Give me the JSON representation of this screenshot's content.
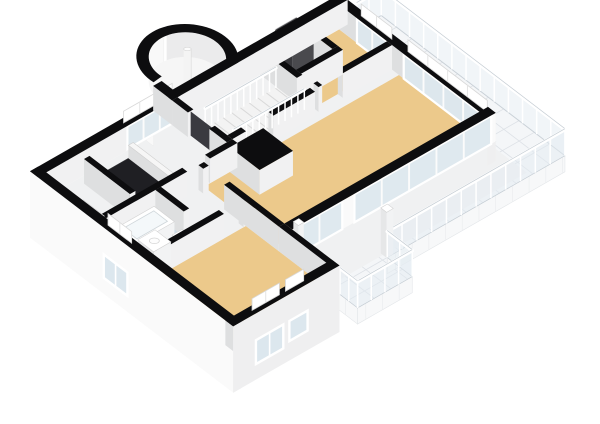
{
  "scene": {
    "label": "3d-floor-plan-isometric-view",
    "width": 600,
    "height": 424,
    "background": "#FFFFFF"
  },
  "palette": {
    "wallTop": "#0D0D0F",
    "wallFaceLight": "#F1F1F2",
    "wallFaceDark": "#DEDFE0",
    "facade": "#FAFAFA",
    "facadeSE": "#EFEFF0",
    "floorWood": "#ECC98B",
    "floorBath": "#CCDAE4",
    "floorBase": "#F0F1F2",
    "floorStone": "#EBEBEC",
    "stairFloor": "#F3F3F3",
    "tile": "#F4F6F8",
    "tileLine": "#DDE1E6",
    "glass": "#DCE7EE",
    "glassRail": "#E4ECF2",
    "frame": "#FFFFFF",
    "frameLine": "#D8D8D8",
    "dark": "#1F1F23",
    "darkDoor": "#3A3A40",
    "boiler": "#4A4A4E",
    "boilerSide": "#38383C",
    "red": "#C23B2E",
    "railPost": "#FFFFFF",
    "railStroke": "#C4CCD3",
    "treadLine": "#D9D9D9"
  },
  "floors": [
    {
      "name": "floor-hall-base",
      "rect": [
        0.28,
        0.28,
        9.92,
        7.02
      ],
      "color": "floorBase"
    },
    {
      "name": "floor-living-room",
      "rect": [
        3.5,
        2.43,
        9.92,
        5.32
      ],
      "color": "floorWood"
    },
    {
      "name": "floor-bedroom-northeast",
      "rect": [
        7.5,
        0.28,
        9.92,
        2.0
      ],
      "color": "floorWood"
    },
    {
      "name": "floor-utility-closet",
      "rect": [
        7.5,
        0.28,
        8.88,
        1.55
      ],
      "color": "floorStone"
    },
    {
      "name": "floor-bedroom-southwest",
      "rect": [
        0.28,
        4.13,
        3.32,
        7.02
      ],
      "color": "floorWood"
    },
    {
      "name": "floor-bathroom",
      "rect": [
        0.28,
        2.43,
        1.9,
        3.95
      ],
      "color": "floorBath"
    },
    {
      "name": "floor-staircase",
      "rect": [
        4.85,
        0.85,
        7.32,
        1.95
      ],
      "color": "stairFloor",
      "kind": "stairs",
      "treadStep": 0.285
    }
  ],
  "stairVoid": {
    "name": "stairwell-void",
    "rect": [
      1.5,
      0.5,
      2.78,
      2.15
    ],
    "color": "dark"
  },
  "terrace": {
    "name": "terrace",
    "z": -0.15,
    "poly": [
      [
        10.2,
        0.45
      ],
      [
        11.15,
        0.45
      ],
      [
        11.15,
        7.05
      ],
      [
        5.3,
        7.05
      ],
      [
        5.3,
        7.95
      ],
      [
        3.5,
        7.95
      ],
      [
        3.5,
        5.6
      ],
      [
        10.2,
        5.6
      ]
    ],
    "gridStep": 0.55,
    "fascia": [
      {
        "plane": "y",
        "at": 7.95,
        "range": [
          3.5,
          5.3
        ]
      },
      {
        "plane": "x",
        "at": 3.5,
        "range": [
          5.6,
          7.95
        ]
      },
      {
        "plane": "y",
        "at": 7.05,
        "range": [
          5.3,
          11.15
        ]
      }
    ],
    "edges": [
      {
        "from": [
          11.15,
          0.45
        ],
        "to": [
          11.15,
          7.05
        ]
      },
      {
        "from": [
          10.34,
          0.45
        ],
        "to": [
          11.15,
          0.45
        ]
      }
    ]
  },
  "elements3d": [
    {
      "type": "wall",
      "name": "wall-north-exterior",
      "rect": [
        0,
        0,
        10.2,
        0.28
      ],
      "swColor": "facade",
      "swBase": -1.6,
      "glassSE": [
        {
          "range": [
            2.95,
            4.55
          ],
          "n": 3,
          "zb": 0.06,
          "zt": 0.93
        }
      ],
      "caps": [
        {
          "side": "se",
          "range": [
            2.95,
            4.55
          ],
          "n": 3
        }
      ]
    },
    {
      "type": "wall",
      "name": "wall-northeast-glazed",
      "rect": [
        9.92,
        0,
        10.2,
        5.6
      ],
      "seColor": "facadeSE",
      "seBase": -0.9,
      "glassSW": [
        {
          "range": [
            0.92,
            2.02
          ],
          "n": 2,
          "zb": 0,
          "zt": 0.93
        },
        {
          "range": [
            2.6,
            5.45
          ],
          "n": 4,
          "zb": 0,
          "zt": 0.93
        }
      ],
      "caps": [
        {
          "side": "sw",
          "range": [
            0.92,
            2.02
          ],
          "n": 2
        },
        {
          "side": "sw",
          "range": [
            2.6,
            5.45
          ],
          "n": 4
        }
      ]
    },
    {
      "type": "wall",
      "name": "wall-southeast-curtain-glass",
      "rect": [
        3.5,
        5.32,
        10.2,
        5.6
      ],
      "seColor": "facade",
      "seBase": -0.15,
      "glassSE": [
        {
          "range": [
            3.65,
            5.15
          ],
          "n": 2,
          "zb": -0.15,
          "zt": 0.93
        },
        {
          "range": [
            5.55,
            10.05
          ],
          "n": 5,
          "zb": -0.15,
          "zt": 0.93
        }
      ]
    },
    {
      "type": "wall",
      "name": "wall-southwest-exterior",
      "rect": [
        0,
        0,
        0.28,
        7.3
      ],
      "swColor": "facade",
      "swBase": -1.6,
      "seColor": "facadeSE",
      "seBase": -1.6,
      "windowsSW": [
        {
          "range": [
            2.65,
            3.5
          ],
          "zt": -0.08,
          "zb": -0.98,
          "n": 2
        }
      ],
      "caps": [
        {
          "side": "sw",
          "range": [
            2.65,
            3.5
          ],
          "n": 2
        }
      ]
    },
    {
      "type": "wall",
      "name": "wall-southeast-bedroom",
      "rect": [
        0,
        7.02,
        3.5,
        7.3
      ],
      "seColor": "facadeSE",
      "seBase": -1.6,
      "windowsSE": [
        {
          "range": [
            0.75,
            1.65
          ],
          "zt": -0.08,
          "zb": -1.0,
          "n": 2
        },
        {
          "range": [
            1.85,
            2.45
          ],
          "zt": -0.08,
          "zb": -0.85,
          "n": 1
        }
      ],
      "caps": [
        {
          "side": "se",
          "range": [
            0.75,
            1.65
          ],
          "n": 2
        },
        {
          "side": "se",
          "range": [
            1.85,
            2.45
          ],
          "n": 1
        }
      ]
    },
    {
      "type": "wall",
      "name": "wall-step-bedroom-east",
      "rect": [
        3.32,
        5.32,
        3.5,
        7.3
      ],
      "seColor": "facadeSE",
      "seBase": -1.6
    },
    {
      "type": "wall",
      "name": "wall-tower-stub",
      "rect": [
        4.42,
        -0.4,
        4.7,
        0.28
      ]
    },
    {
      "type": "wall",
      "name": "wall-hall-south-a",
      "rect": [
        0.28,
        2.25,
        2.95,
        2.43
      ]
    },
    {
      "type": "wall",
      "name": "wall-hall-south-b",
      "rect": [
        3.7,
        2.25,
        4.6,
        2.43
      ]
    },
    {
      "type": "wall",
      "name": "wall-hall-east-a",
      "rect": [
        4.42,
        0.28,
        4.6,
        0.85
      ]
    },
    {
      "type": "wall",
      "name": "wall-hall-east-b",
      "rect": [
        4.42,
        1.62,
        4.6,
        2.25
      ]
    },
    {
      "type": "face",
      "name": "doorway-dark-opening",
      "plane": "x",
      "at": 4.51,
      "range": [
        0.85,
        1.62
      ],
      "zb": 0,
      "zt": 0.93,
      "color": "darkDoor"
    },
    {
      "type": "wall",
      "name": "wall-bathroom-east",
      "rect": [
        1.9,
        2.43,
        2.08,
        3.45
      ]
    },
    {
      "type": "wall",
      "name": "wall-bathroom-south",
      "rect": [
        0.28,
        3.95,
        2.6,
        4.13
      ]
    },
    {
      "type": "wall",
      "name": "wall-bathroom-south-stub",
      "rect": [
        3.25,
        3.95,
        3.32,
        4.13
      ]
    },
    {
      "type": "wall",
      "name": "wall-corridor-east-a",
      "rect": [
        3.32,
        2.43,
        3.5,
        2.6
      ]
    },
    {
      "type": "wall",
      "name": "wall-corridor-east-b",
      "rect": [
        3.32,
        3.35,
        3.5,
        5.32
      ]
    },
    {
      "type": "wall",
      "name": "wall-ne-bedroom-south-a",
      "rect": [
        7.5,
        2.0,
        7.62,
        2.18
      ]
    },
    {
      "type": "wall",
      "name": "wall-ne-bedroom-south-b",
      "rect": [
        8.3,
        2.0,
        9.92,
        2.18
      ]
    },
    {
      "type": "wall",
      "name": "wall-landing-east",
      "rect": [
        7.32,
        0.28,
        7.5,
        1.6
      ]
    },
    {
      "type": "wall",
      "name": "wall-closet-south",
      "rect": [
        7.5,
        1.37,
        8.88,
        1.55
      ]
    },
    {
      "type": "wall",
      "name": "wall-closet-east",
      "rect": [
        8.7,
        0.28,
        8.88,
        1.37
      ]
    },
    {
      "type": "wall",
      "name": "wall-stairs-south-a",
      "rect": [
        4.6,
        2.07,
        5.05,
        2.25
      ]
    },
    {
      "type": "wall",
      "name": "wall-stairs-south-b",
      "rect": [
        5.95,
        2.07,
        7.32,
        2.25
      ]
    },
    {
      "type": "wall",
      "name": "wall-void-west",
      "rect": [
        1.32,
        0.5,
        1.5,
        2.15
      ]
    },
    {
      "type": "wall",
      "name": "curb-void-east",
      "rect": [
        2.78,
        0.5,
        2.94,
        2.15
      ],
      "h": 0.5,
      "top": "#F6F6F6",
      "topStroke": "#CFCFCF"
    },
    {
      "type": "wall",
      "name": "closet-block-living",
      "rect": [
        4.35,
        2.43,
        5.45,
        3.5
      ]
    },
    {
      "type": "rail",
      "name": "railing-balcony-east",
      "from": [
        11.15,
        0.45
      ],
      "to": [
        11.15,
        7.05
      ]
    },
    {
      "type": "rail",
      "name": "railing-balcony-north-cap",
      "from": [
        10.34,
        0.45
      ],
      "to": [
        11.15,
        0.45
      ]
    },
    {
      "type": "rail",
      "name": "railing-terrace-south",
      "from": [
        5.3,
        7.05
      ],
      "to": [
        11.15,
        7.05
      ]
    },
    {
      "type": "rail",
      "name": "railing-terrace-step",
      "from": [
        5.3,
        7.05
      ],
      "to": [
        5.3,
        7.95
      ]
    },
    {
      "type": "rail",
      "name": "railing-terrace-front",
      "from": [
        3.5,
        7.95
      ],
      "to": [
        5.3,
        7.95
      ]
    },
    {
      "type": "rail",
      "name": "railing-terrace-west",
      "from": [
        3.5,
        7.32
      ],
      "to": [
        3.5,
        7.95
      ]
    },
    {
      "type": "rail",
      "name": "balustrade-stairs-north",
      "from": [
        4.95,
        0.89
      ],
      "to": [
        7.28,
        0.89
      ],
      "zb": 0,
      "zt": 0.78,
      "step": 0.22,
      "glass": false
    },
    {
      "type": "rail",
      "name": "balustrade-stairs-south",
      "from": [
        4.95,
        1.91
      ],
      "to": [
        7.28,
        1.91
      ],
      "zb": 0,
      "zt": 0.78,
      "step": 0.22,
      "glass": false
    },
    {
      "type": "box",
      "name": "bathtub",
      "rect": [
        0.5,
        2.55,
        1.75,
        3.28
      ],
      "zt": 0.52,
      "kind": "tub"
    },
    {
      "type": "box",
      "name": "vanity-sink",
      "rect": [
        0.45,
        3.38,
        1.02,
        3.95
      ],
      "zt": 0.78,
      "kind": "vanity"
    },
    {
      "type": "box",
      "name": "toilet",
      "rect": [
        1.45,
        3.52,
        1.78,
        3.82
      ],
      "zt": 0.4,
      "kind": "toilet"
    },
    {
      "type": "box",
      "name": "radiator",
      "rect": [
        0.32,
        1.35,
        0.52,
        2.1
      ],
      "zt": 0.6,
      "kind": "radiator"
    },
    {
      "type": "box",
      "name": "boiler-unit",
      "rect": [
        7.72,
        0.38,
        8.42,
        1.0
      ],
      "zt": 1.55,
      "kind": "boiler",
      "topColor": "boiler",
      "swColor": "boilerSide",
      "seColor": "boiler"
    },
    {
      "type": "box",
      "name": "terrace-column",
      "rect": [
        5.28,
        6.84,
        5.5,
        7.05
      ],
      "zb": -0.15,
      "zt": 1.6
    },
    {
      "type": "box",
      "name": "glass-corner-column",
      "rect": [
        3.52,
        5.62,
        3.7,
        5.8
      ],
      "zb": 0,
      "zt": 1.25
    },
    {
      "type": "tower",
      "name": "stair-tower",
      "c": [
        5.75,
        -0.62
      ],
      "rO": 1.24,
      "rI": 0.94,
      "gapDeg": [
        90,
        174
      ],
      "column": {
        "r": 0.13,
        "zb": -0.5,
        "zt": 1.3
      }
    }
  ]
}
